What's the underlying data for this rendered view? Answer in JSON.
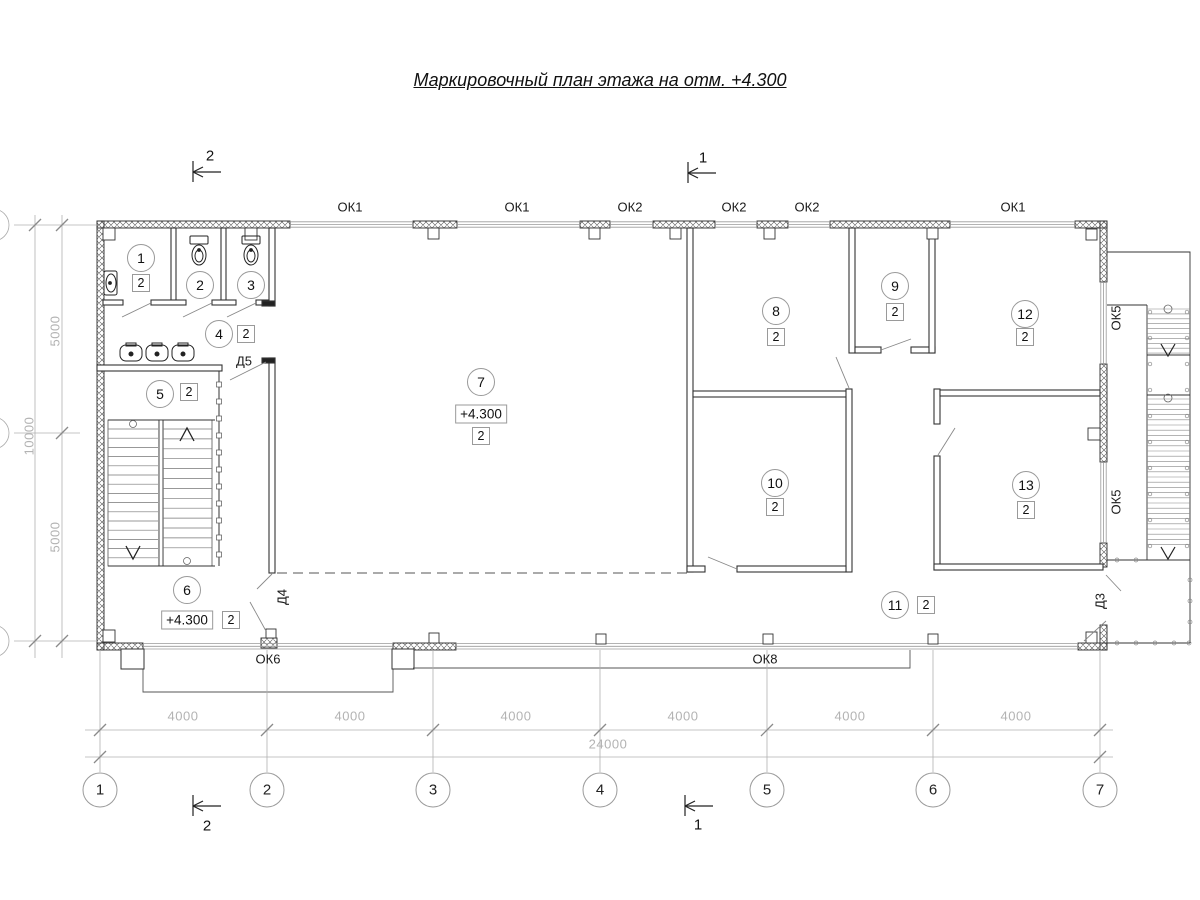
{
  "title": {
    "text": "Маркировочный план этажа на отм. +4.300"
  },
  "rooms": [
    {
      "num": "1",
      "cx": 141,
      "cy": 258,
      "cat": "2",
      "sx": 141,
      "sy": 283
    },
    {
      "num": "2",
      "cx": 200,
      "cy": 285
    },
    {
      "num": "3",
      "cx": 251,
      "cy": 285
    },
    {
      "num": "4",
      "cx": 219,
      "cy": 334,
      "cat": "2",
      "sx": 246,
      "sy": 334
    },
    {
      "num": "5",
      "cx": 160,
      "cy": 394,
      "cat": "2",
      "sx": 189,
      "sy": 392
    },
    {
      "num": "6",
      "cx": 187,
      "cy": 590,
      "cat": "2",
      "sx": 231,
      "sy": 620,
      "elev": "+4.300",
      "ex": 187,
      "ey": 620
    },
    {
      "num": "7",
      "cx": 481,
      "cy": 382,
      "cat": "2",
      "sx": 481,
      "sy": 436,
      "elev": "+4.300",
      "ex": 481,
      "ey": 414
    },
    {
      "num": "8",
      "cx": 776,
      "cy": 311,
      "cat": "2",
      "sx": 776,
      "sy": 337
    },
    {
      "num": "9",
      "cx": 895,
      "cy": 286,
      "cat": "2",
      "sx": 895,
      "sy": 312
    },
    {
      "num": "10",
      "cx": 775,
      "cy": 483,
      "cat": "2",
      "sx": 775,
      "sy": 507
    },
    {
      "num": "11",
      "cx": 895,
      "cy": 605,
      "cat": "2",
      "sx": 926,
      "sy": 605
    },
    {
      "num": "12",
      "cx": 1025,
      "cy": 314,
      "cat": "2",
      "sx": 1025,
      "sy": 337
    },
    {
      "num": "13",
      "cx": 1026,
      "cy": 485,
      "cat": "2",
      "sx": 1026,
      "sy": 510
    }
  ],
  "labels": [
    {
      "name": "window-label-ok1-a",
      "text": "ОК1",
      "x": 350,
      "y": 207,
      "cls": "lbl-mark"
    },
    {
      "name": "window-label-ok1-b",
      "text": "ОК1",
      "x": 517,
      "y": 207,
      "cls": "lbl-mark"
    },
    {
      "name": "window-label-ok2-a",
      "text": "ОК2",
      "x": 630,
      "y": 207,
      "cls": "lbl-mark"
    },
    {
      "name": "window-label-ok2-b",
      "text": "ОК2",
      "x": 734,
      "y": 207,
      "cls": "lbl-mark"
    },
    {
      "name": "window-label-ok2-c",
      "text": "ОК2",
      "x": 807,
      "y": 207,
      "cls": "lbl-mark"
    },
    {
      "name": "window-label-ok1-c",
      "text": "ОК1",
      "x": 1013,
      "y": 207,
      "cls": "lbl-mark"
    },
    {
      "name": "window-label-ok6",
      "text": "ОК6",
      "x": 268,
      "y": 659,
      "cls": "lbl-mark"
    },
    {
      "name": "window-label-ok8",
      "text": "ОК8",
      "x": 765,
      "y": 659,
      "cls": "lbl-mark"
    },
    {
      "name": "window-label-ok5-a",
      "text": "ОК5",
      "x": 1116,
      "y": 318,
      "cls": "lbl-mark",
      "rot": true
    },
    {
      "name": "window-label-ok5-b",
      "text": "ОК5",
      "x": 1116,
      "y": 502,
      "cls": "lbl-mark",
      "rot": true
    },
    {
      "name": "door-label-d5",
      "text": "Д5",
      "x": 244,
      "y": 361,
      "cls": "lbl-mark"
    },
    {
      "name": "door-label-d4",
      "text": "Д4",
      "x": 282,
      "y": 597,
      "cls": "lbl-mark",
      "rot": true
    },
    {
      "name": "door-label-d3",
      "text": "Д3",
      "x": 1100,
      "y": 601,
      "cls": "lbl-mark",
      "rot": true
    },
    {
      "name": "dim-4000-1",
      "text": "4000",
      "x": 183,
      "y": 716,
      "cls": "lbl-dim"
    },
    {
      "name": "dim-4000-2",
      "text": "4000",
      "x": 350,
      "y": 716,
      "cls": "lbl-dim"
    },
    {
      "name": "dim-4000-3",
      "text": "4000",
      "x": 516,
      "y": 716,
      "cls": "lbl-dim"
    },
    {
      "name": "dim-4000-4",
      "text": "4000",
      "x": 683,
      "y": 716,
      "cls": "lbl-dim"
    },
    {
      "name": "dim-4000-5",
      "text": "4000",
      "x": 850,
      "y": 716,
      "cls": "lbl-dim"
    },
    {
      "name": "dim-4000-6",
      "text": "4000",
      "x": 1016,
      "y": 716,
      "cls": "lbl-dim"
    },
    {
      "name": "dim-24000",
      "text": "24000",
      "x": 608,
      "y": 744,
      "cls": "lbl-dim"
    },
    {
      "name": "dim-5000-top",
      "text": "5000",
      "x": 55,
      "y": 331,
      "cls": "lbl-dim",
      "rot": true
    },
    {
      "name": "dim-10000",
      "text": "10000",
      "x": 29,
      "y": 436,
      "cls": "lbl-dim",
      "rot": true
    },
    {
      "name": "dim-5000-bottom",
      "text": "5000",
      "x": 55,
      "y": 537,
      "cls": "lbl-dim",
      "rot": true
    },
    {
      "name": "section-label-2-top",
      "text": "2",
      "x": 210,
      "y": 156,
      "cls": "lbl-sec"
    },
    {
      "name": "section-label-1-top",
      "text": "1",
      "x": 703,
      "y": 158,
      "cls": "lbl-sec"
    },
    {
      "name": "section-label-2-bottom",
      "text": "2",
      "x": 207,
      "y": 826,
      "cls": "lbl-sec"
    },
    {
      "name": "section-label-1-bottom",
      "text": "1",
      "x": 698,
      "y": 825,
      "cls": "lbl-sec"
    }
  ],
  "axes_bottom": [
    {
      "label": "1",
      "x": 100
    },
    {
      "label": "2",
      "x": 267
    },
    {
      "label": "3",
      "x": 433
    },
    {
      "label": "4",
      "x": 600
    },
    {
      "label": "5",
      "x": 767
    },
    {
      "label": "6",
      "x": 933
    },
    {
      "label": "7",
      "x": 1100
    }
  ],
  "axes_bottom_y": 790,
  "colors": {
    "line": "#2a2a2a",
    "interior": "#333333",
    "gray": "#9a9a9a",
    "dim": "#b3b3b3"
  }
}
